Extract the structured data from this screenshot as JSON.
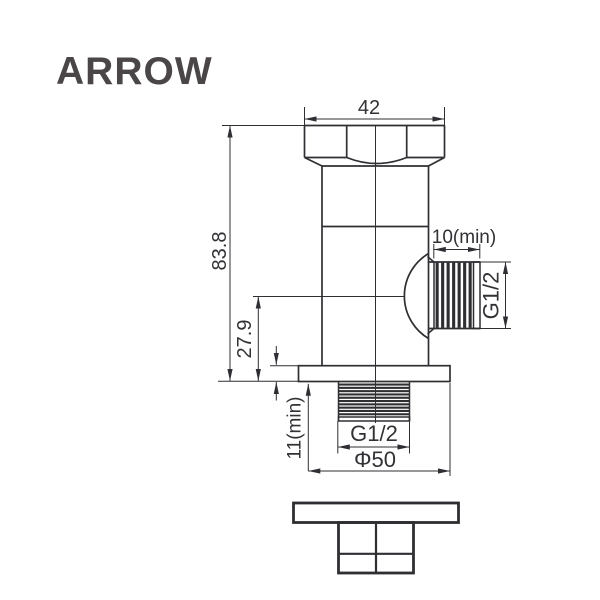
{
  "page": {
    "background": "#ffffff"
  },
  "brand": {
    "logo_text": "ARROW",
    "logo_color": "#4a4648"
  },
  "drawing": {
    "description": "angle valve front elevation with dimensions and wall plate bottom part",
    "line_color": "#2f2f33",
    "text_color": "#323236",
    "dimensions": {
      "cap_width": "42",
      "overall_height": "83.8",
      "outlet_center_to_base": "27.9",
      "outlet_thread_min_length": "10(min)",
      "outlet_thread_size": "G1/2",
      "inlet_thread_min_length": "11(min)",
      "inlet_thread_size": "G1/2",
      "base_diameter": "Φ50"
    }
  }
}
